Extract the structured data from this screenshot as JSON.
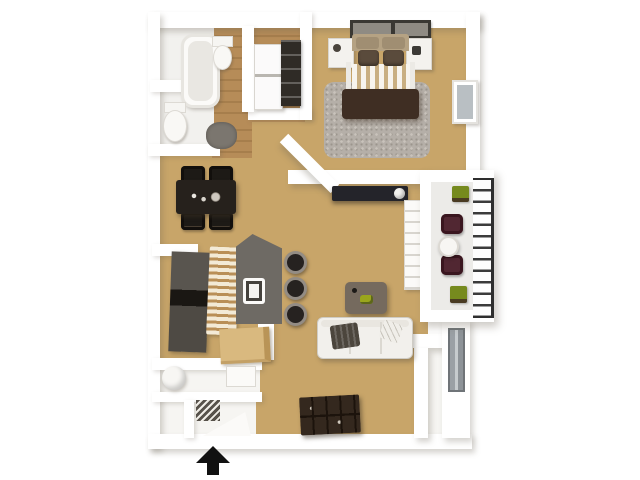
{
  "type": "3d-floor-plan",
  "title": "One-bedroom, one-bath apartment 3D floor plan, top-down view",
  "palette": {
    "background": "#ffffff",
    "wall": "#ffffff",
    "carpet": "#c8a569",
    "wood": "#b68c58",
    "bathFloor": "#f2f1ee",
    "balconyFloor": "#ecebe8",
    "rug": "#b5afa8",
    "headboard": "#b5a283",
    "bedPillow": "#5a4b3c",
    "sheetStripe": "#c9af82",
    "bedBlanket": "#3f2e23",
    "darkFurniture": "#26211c",
    "island": "#6e6a64",
    "woodCabinet": "#d9b97f",
    "sofa": "#f2f0ec",
    "throw": "#4c463d",
    "coffeeTable": "#756a5e",
    "accentGreen": "#9aa61d",
    "balconyChair": "#512732",
    "planterGreen": "#768a1e",
    "railing": "#3a3a3a",
    "glass": "#b9bfc3",
    "arrow": "#111111"
  },
  "rooms": {
    "bathroom": {
      "name": "Bathroom with tub, toilet and sink",
      "floor": "white tile / wood"
    },
    "laundry": {
      "name": "Laundry closet with stacked washer-dryer and shelving",
      "floor": "wood"
    },
    "bedroom": {
      "name": "Bedroom with queen bed, nightstands, shag rug and window",
      "floor": "carpet"
    },
    "dining": {
      "name": "Dining area with table for four",
      "floor": "carpet"
    },
    "kitchen": {
      "name": "Kitchen with refrigerator, island sink and bar stools",
      "floor": "carpet"
    },
    "living": {
      "name": "Living room with sofa, coffee table and media consoles",
      "floor": "carpet"
    },
    "balcony": {
      "name": "Balcony with two chairs, bistro table and planters",
      "floor": "concrete"
    },
    "utility": {
      "name": "Utility closet with water heater",
      "floor": "white tile"
    },
    "entry": {
      "name": "Entry hall",
      "floor": "white tile"
    }
  },
  "furniture": {
    "bathtub": "bathtub",
    "toilet": "toilet",
    "pedestal_sink": "pedestal sink",
    "bath_rug": "gray bath rug",
    "washer_dryer": "stacked washer and dryer",
    "closet_shelves": "dark closet shelving",
    "bed": "queen bed with brown comforter and striped sheets",
    "nightstand_left": "left nightstand",
    "nightstand_right": "right nightstand",
    "wall_art_left": "framed wall art",
    "wall_art_right": "framed wall art",
    "shag_rug": "gray shag area rug",
    "bedroom_window": "bedroom window",
    "dining_table": "dark wood dining table",
    "dining_chair": "dining chair",
    "refrigerator": "refrigerator",
    "slat_cabinet": "slatted cabinet front",
    "kitchen_island": "gray kitchen island with sink",
    "bar_stool": "round bar stool",
    "wood_cabinet": "light wood base cabinet",
    "media_console": "dark media console with lamp",
    "coffee_table": "coffee table with green tray",
    "sofa": "white three-seat sofa with dark throw",
    "media_cabinet": "dark cubby media cabinet",
    "shelf_unit": "white shelf unit",
    "balcony_chair": "maroon patio chair",
    "balcony_table": "round patio table",
    "planter": "green planter box",
    "water_heater": "water heater",
    "patio_slider": "sliding glass door"
  },
  "entry_marker": {
    "shape": "arrow",
    "direction": "up",
    "meaning": "main entry"
  }
}
